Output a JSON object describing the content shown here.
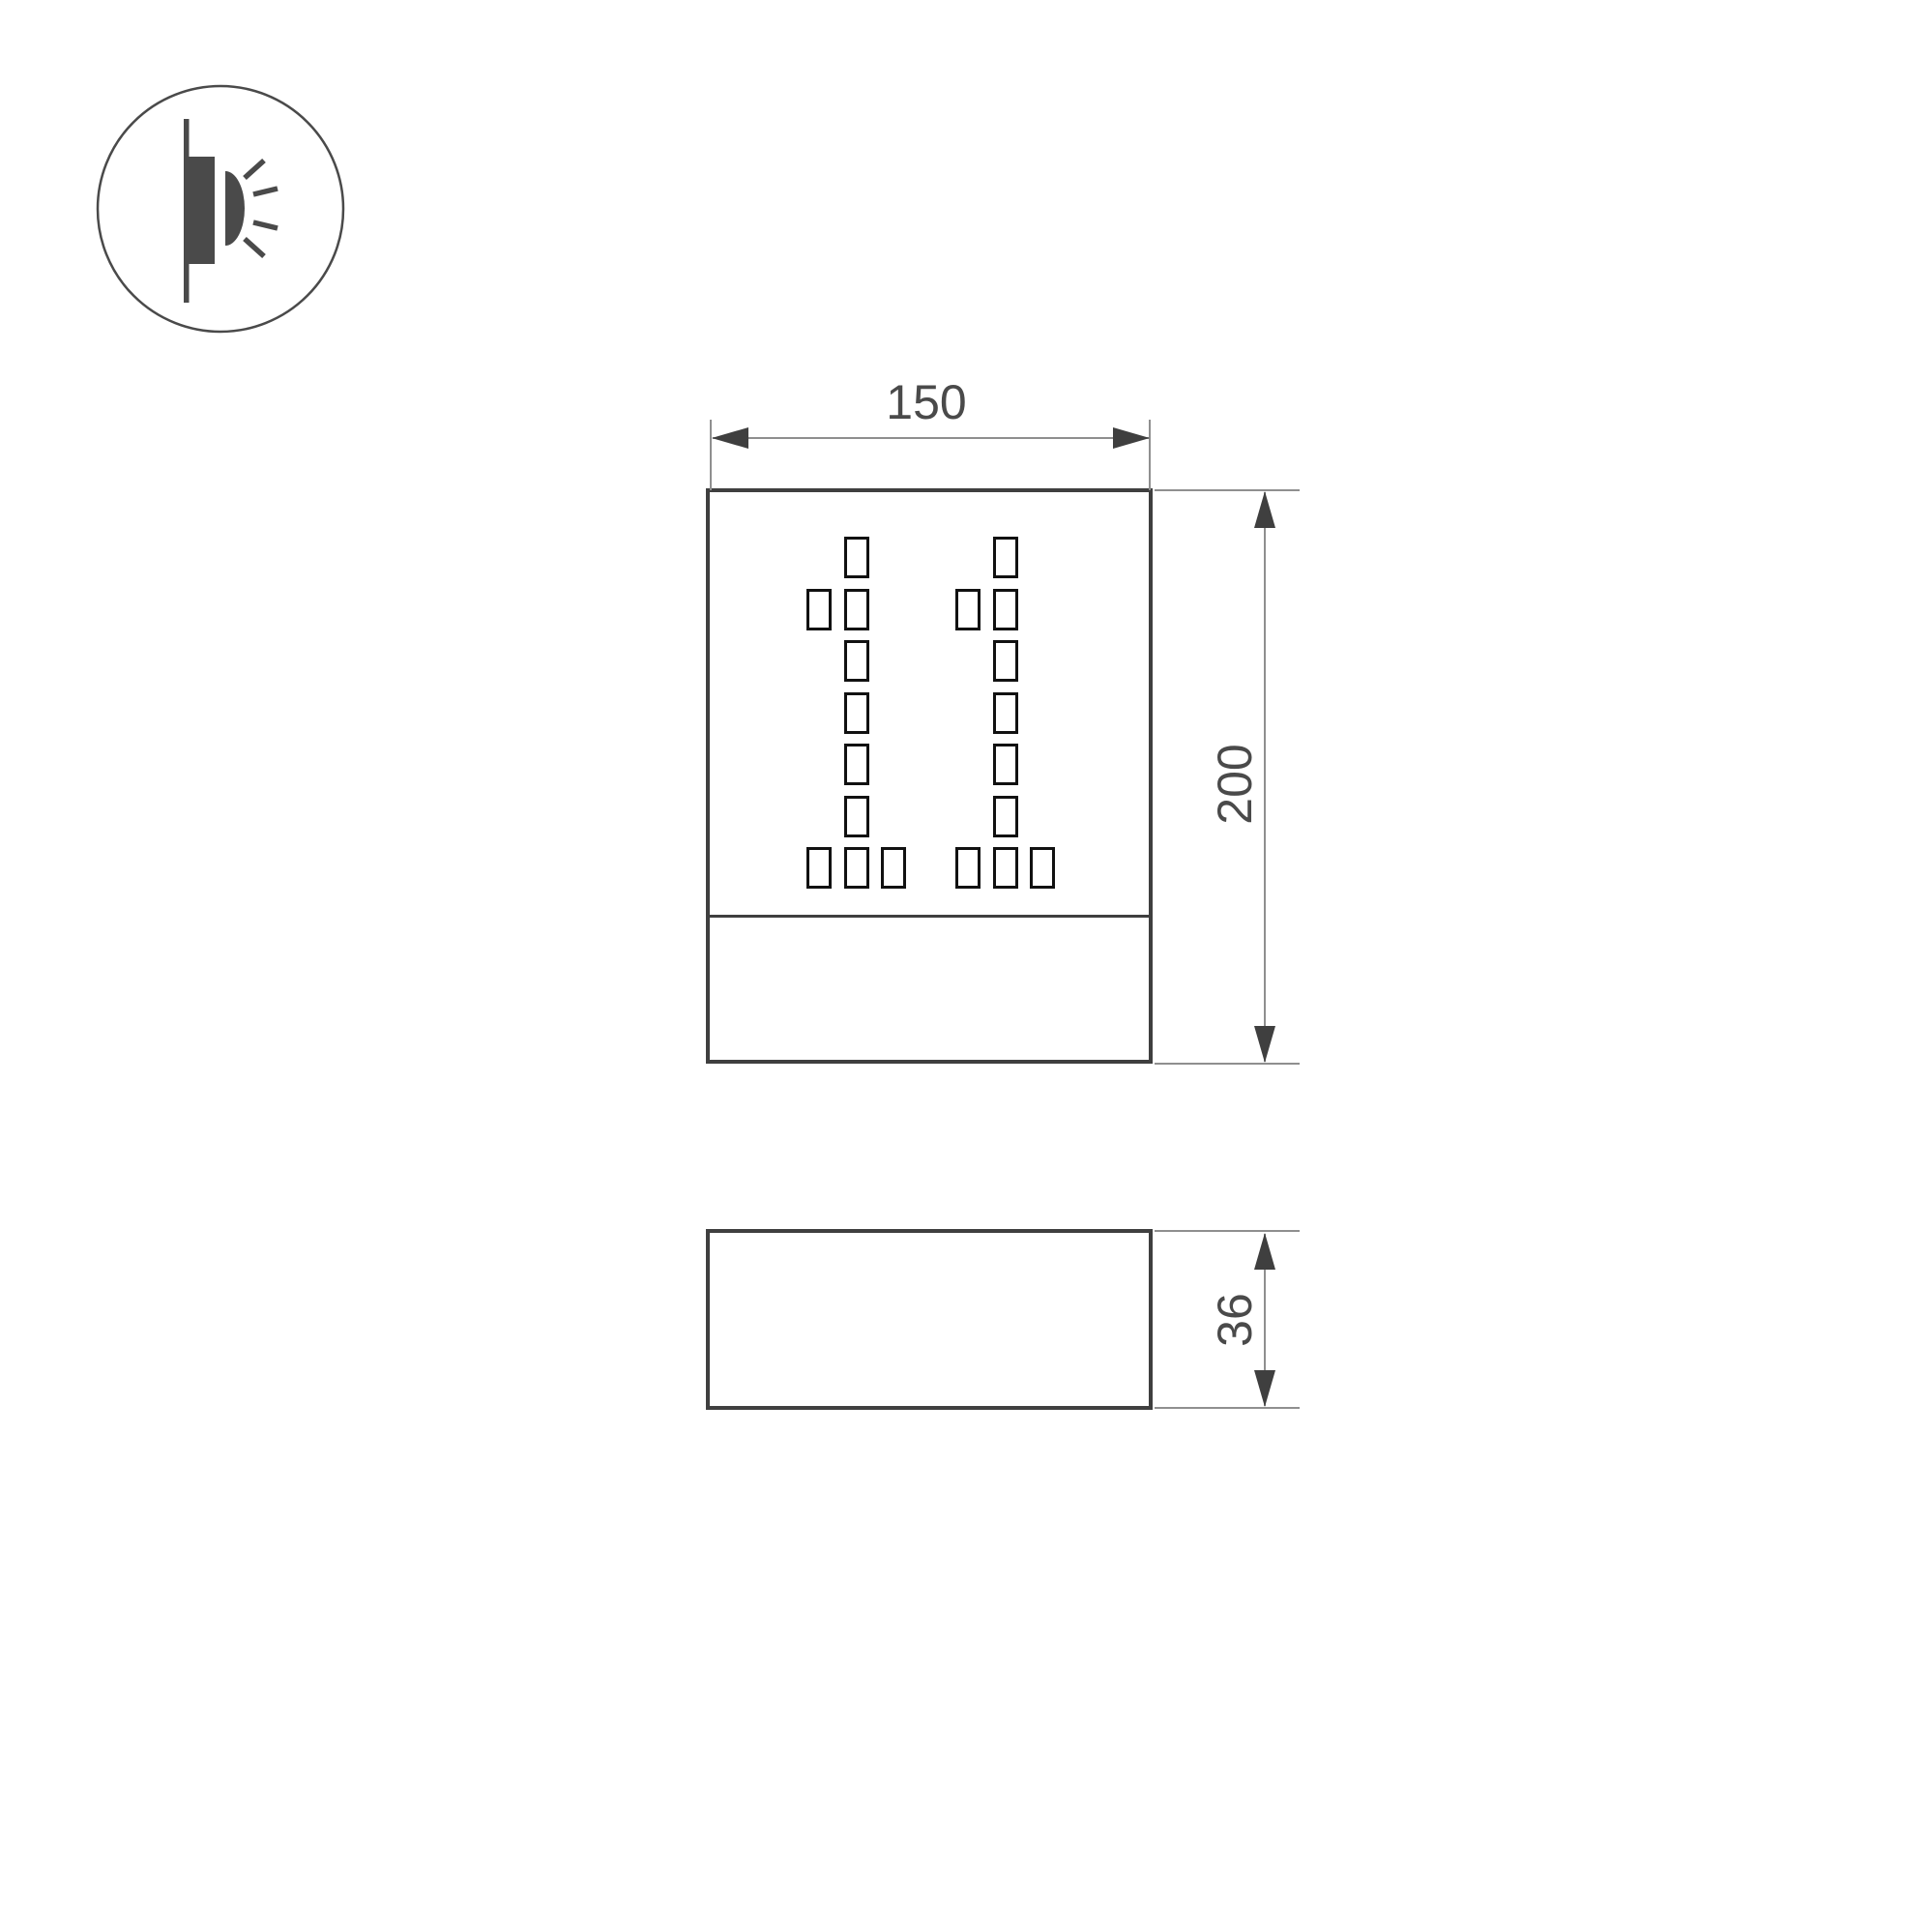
{
  "drawing": {
    "type": "luminaire-dimension-drawing",
    "front_view": {
      "width_label": "150",
      "height_label": "200"
    },
    "side_view": {
      "depth_label": "36"
    },
    "display": {
      "value": "11",
      "digit_pattern": [
        "010",
        "110",
        "010",
        "010",
        "010",
        "010",
        "111"
      ]
    }
  },
  "icon": {
    "name": "wall-mounted-light-emission-icon"
  },
  "colors": {
    "outline": "#3f3f3f",
    "perforation": "#111111",
    "dim_line": "#8f8f8f",
    "arrow": "#3f3f3f",
    "text": "#4a4a4a",
    "icon": "#4a4a4a",
    "background": "#ffffff"
  }
}
